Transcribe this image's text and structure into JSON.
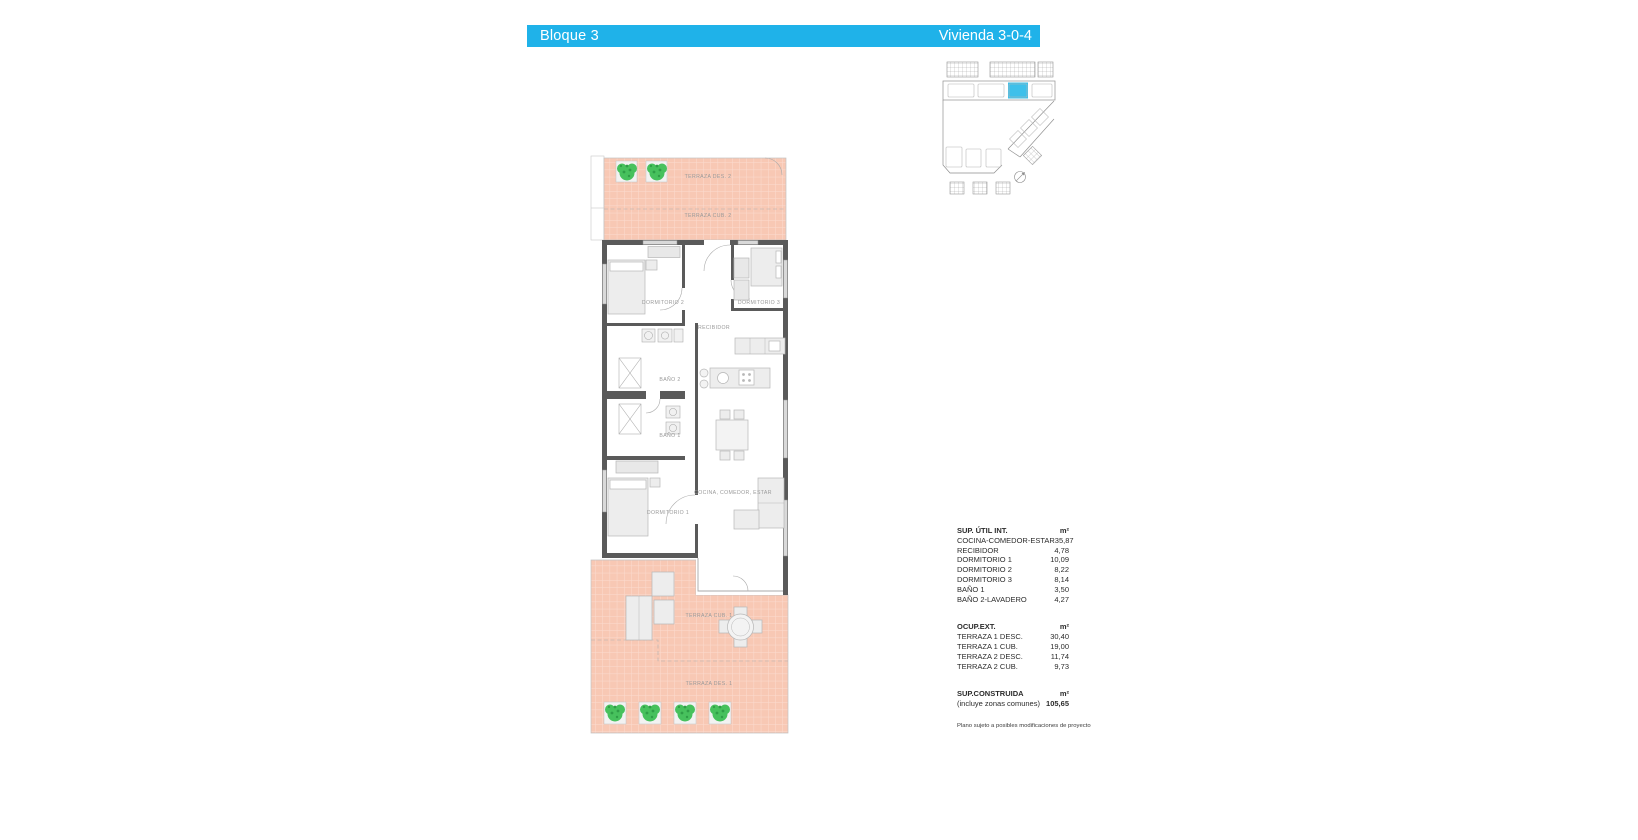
{
  "header": {
    "block_label": "Bloque 3",
    "unit_label": "Vivienda 3-0-4",
    "background": "#1FB2E9",
    "text_color": "#FFFFFF"
  },
  "keyplan": {
    "highlight_color": "#3EC0EA"
  },
  "plan": {
    "labels": {
      "terraza_des_2": "TERRAZA DES. 2",
      "terraza_cub_2": "TERRAZA CUB. 2",
      "dormitorio_2": "DORMITORIO 2",
      "dormitorio_3": "DORMITORIO 3",
      "recibidor": "RECIBIDOR",
      "bano_2": "BAÑO 2",
      "bano_1": "BAÑO 1",
      "dormitorio_1": "DORMITORIO 1",
      "cocina_comedor_estar": "COCINA, COMEDOR, ESTAR",
      "terraza_cub_1": "TERRAZA CUB. 1",
      "terraza_des_1": "TERRAZA DES. 1"
    },
    "colors": {
      "terrace_fill": "#F8C8B4",
      "terrace_grid": "#FBDCD0",
      "wall": "#5A5A5A",
      "furniture": "#EDEDED",
      "plant_green": "#47C15D",
      "label_text": "#9A9A9A"
    }
  },
  "areas": {
    "sections": [
      {
        "title": "SUP. ÚTIL INT.",
        "unit": "m²",
        "rows": [
          {
            "label": "COCINA-COMEDOR-ESTAR",
            "value": "35,87"
          },
          {
            "label": "RECIBIDOR",
            "value": "4,78"
          },
          {
            "label": "DORMITORIO 1",
            "value": "10,09"
          },
          {
            "label": "DORMITORIO 2",
            "value": "8,22"
          },
          {
            "label": "DORMITORIO 3",
            "value": "8,14"
          },
          {
            "label": "BAÑO 1",
            "value": "3,50"
          },
          {
            "label": "BAÑO 2-LAVADERO",
            "value": "4,27"
          }
        ]
      },
      {
        "title": "OCUP.EXT.",
        "unit": "m²",
        "rows": [
          {
            "label": "TERRAZA 1 DESC.",
            "value": "30,40"
          },
          {
            "label": "TERRAZA 1 CUB.",
            "value": "19,00"
          },
          {
            "label": "TERRAZA 2 DESC.",
            "value": "11,74"
          },
          {
            "label": "TERRAZA 2 CUB.",
            "value": "9,73"
          }
        ]
      },
      {
        "title": "SUP.CONSTRUIDA",
        "unit": "m²",
        "rows": [
          {
            "label": "(incluye zonas comunes)",
            "value": "105,65"
          }
        ]
      }
    ],
    "disclaimer": "Plano sujeto a posibles modificaciones de proyecto"
  }
}
